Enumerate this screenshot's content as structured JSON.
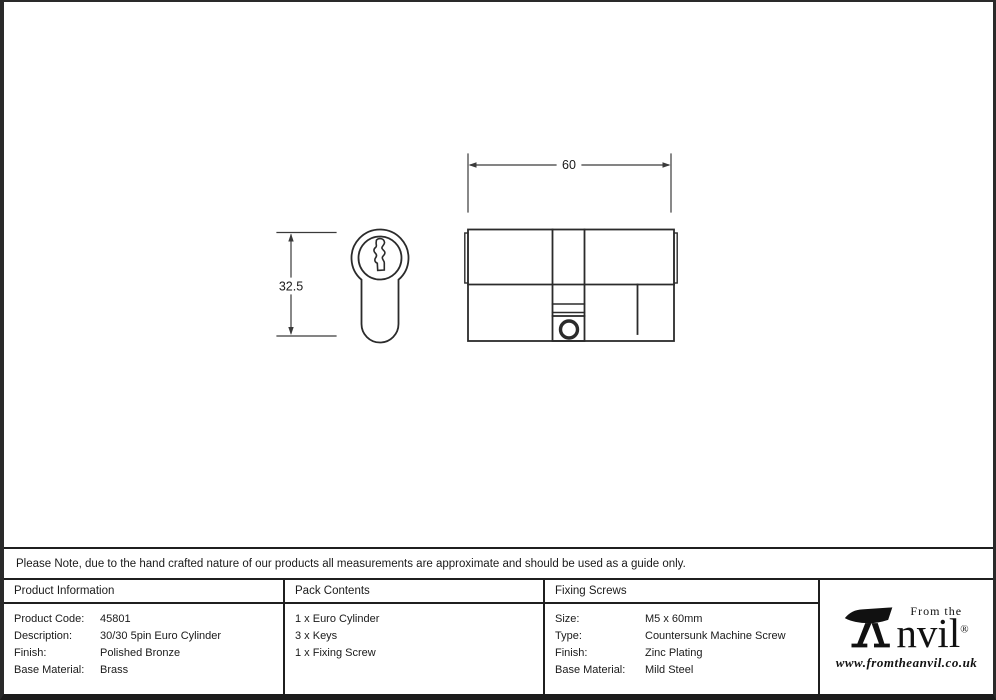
{
  "drawing": {
    "dim_width_label": "60",
    "dim_height_label": "32.5"
  },
  "note": {
    "text": "Please Note, due to the hand crafted nature of our products all measurements are approximate and should be used as a guide only."
  },
  "table": {
    "product_information": {
      "header": "Product Information",
      "rows": [
        {
          "label": "Product Code:",
          "value": "45801"
        },
        {
          "label": "Description:",
          "value": "30/30 5pin Euro Cylinder"
        },
        {
          "label": "Finish:",
          "value": "Polished Bronze"
        },
        {
          "label": "Base Material:",
          "value": "Brass"
        }
      ]
    },
    "pack_contents": {
      "header": "Pack Contents",
      "items": [
        "1 x Euro Cylinder",
        "3 x Keys",
        "1 x Fixing Screw"
      ]
    },
    "fixing_screws": {
      "header": "Fixing Screws",
      "rows": [
        {
          "label": "Size:",
          "value": "M5 x 60mm"
        },
        {
          "label": "Type:",
          "value": "Countersunk Machine Screw"
        },
        {
          "label": "Finish:",
          "value": "Zinc Plating"
        },
        {
          "label": "Base Material:",
          "value": "Mild Steel"
        }
      ]
    }
  },
  "logo": {
    "from_the": "From the",
    "name_rest": "nvil",
    "registered": "®",
    "url": "www.fromtheanvil.co.uk"
  },
  "colors": {
    "line": "#2b2b2b",
    "dim_line": "#3a3a3a",
    "border": "#1f1f1f",
    "text": "#1a1a1a"
  }
}
